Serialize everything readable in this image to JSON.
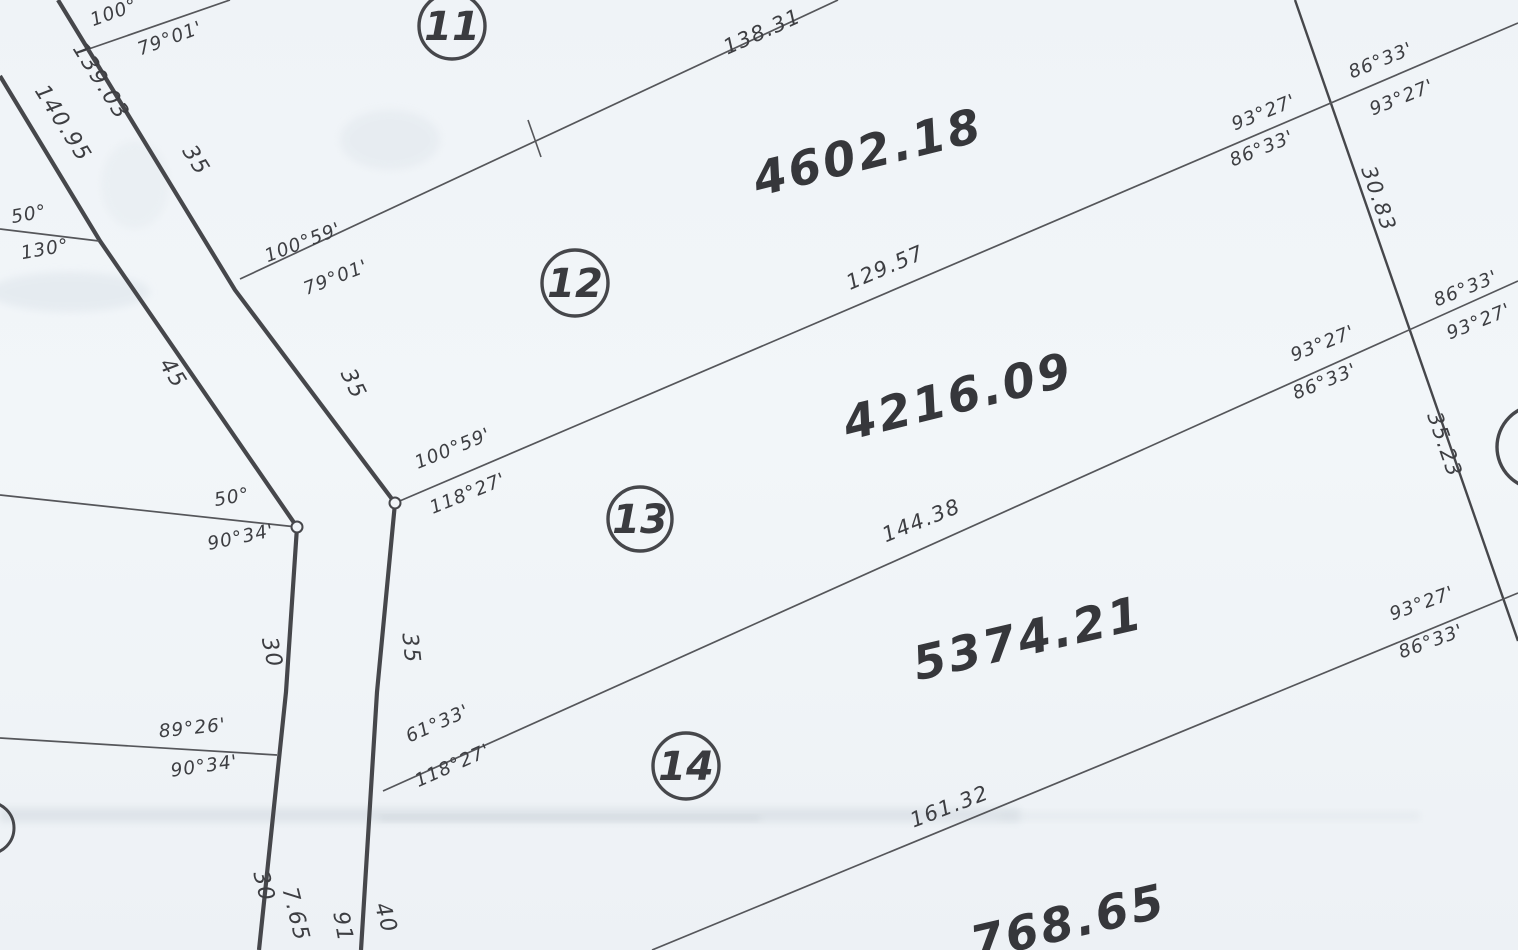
{
  "parcels": {
    "p11": {
      "number": "11"
    },
    "p12": {
      "number": "12",
      "area": "4602.18"
    },
    "p13": {
      "number": "13",
      "area": "4216.09"
    },
    "p14": {
      "number": "14",
      "area": "5374.21"
    },
    "p15": {
      "area_partial": "768.65"
    }
  },
  "lot_line_lengths": {
    "line_11_12": "138.31",
    "line_12_13": "129.57",
    "line_13_14": "144.38",
    "line_14_15": "161.32"
  },
  "west_road": {
    "frontage_upper_west": "140.95",
    "frontage_upper_east": "139.03",
    "width_upper": "35",
    "width_mid_west": "45",
    "width_mid_east": "35",
    "width_lower_west": "30",
    "width_lower_east": "35",
    "width_bottom_west": "30",
    "frontage_bottom_west_partial": "7.65",
    "frontage_bottom_east": "91",
    "width_bottom_east": "40"
  },
  "east_road": {
    "seg_11_12": "30.83",
    "seg_12_13": "35.23"
  },
  "bearings": {
    "b100_partial": "100°",
    "b79_01": "79°01'",
    "b100_59": "100°59'",
    "b118_27": "118°27'",
    "b61_33": "61°33'",
    "b93_27": "93°27'",
    "b86_33": "86°33'",
    "b50": "50°",
    "b130": "130°",
    "b90_34": "90°34'",
    "b89_26": "89°26'"
  },
  "colors": {
    "ink": "#46474b",
    "paper": "#f1f5f8"
  }
}
